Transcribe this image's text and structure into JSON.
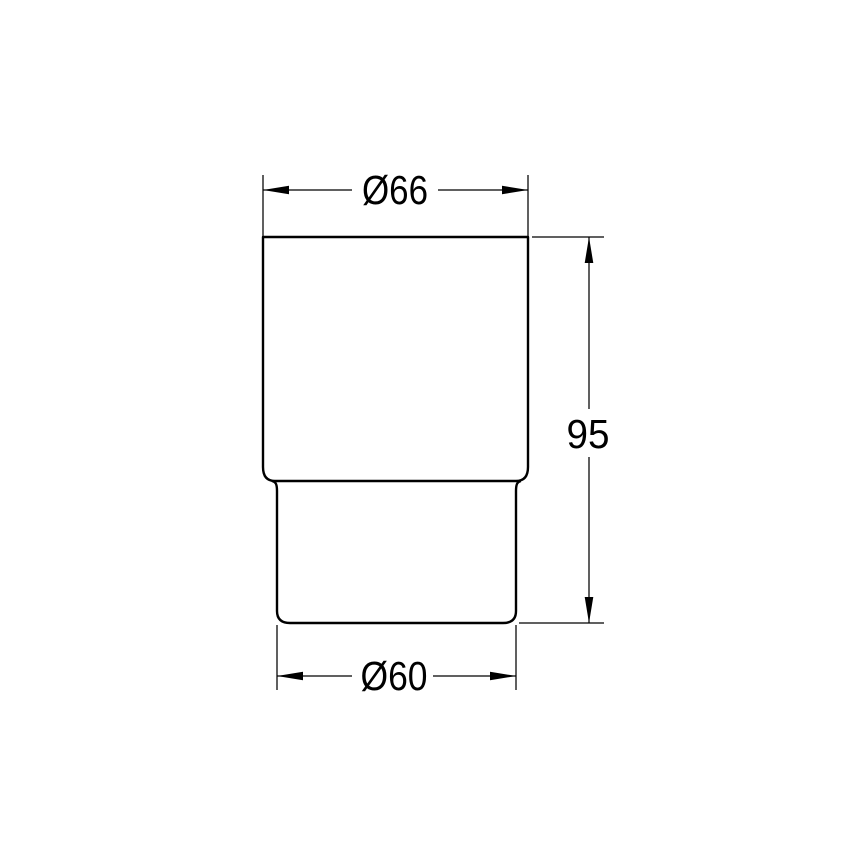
{
  "drawing": {
    "kind": "technical-dimension-drawing",
    "dimensions": {
      "top_diameter": "Ø66",
      "height": "95",
      "bottom_diameter": "Ø60"
    }
  },
  "colors": {
    "background": "#ffffff",
    "line": "#000000"
  }
}
